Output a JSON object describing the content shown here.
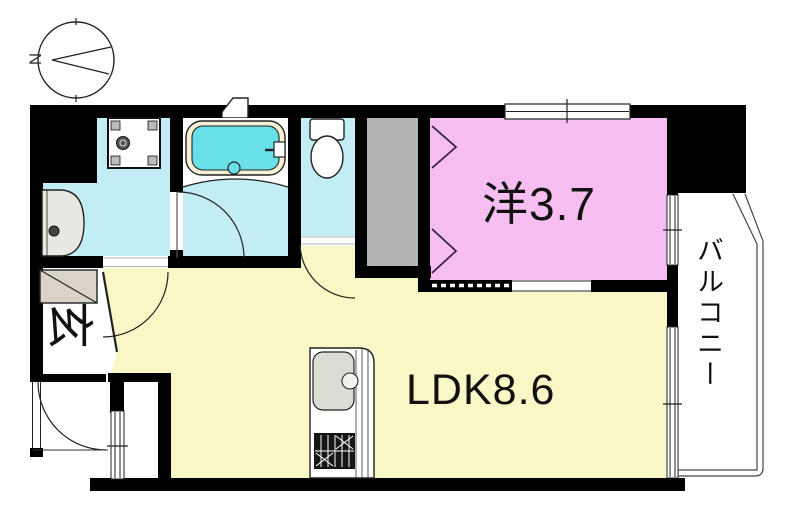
{
  "compass": {
    "north": "N"
  },
  "labels": {
    "western_room": "洋3.7",
    "ldk": "LDK8.6",
    "entrance": "玄",
    "balcony": "バルコニー"
  },
  "colors": {
    "wet_rooms": "#c3edf5",
    "bath_water": "#68dfe9",
    "tub_rim": "#f6f1d5",
    "western_room": "#f6bdf0",
    "ldk": "#faf7c6",
    "closet": "#b2b2b2",
    "shoe_cabinet": "#d9d3c9",
    "sink": "#dcdbd4",
    "washbasin": "#e8e7e1",
    "wall": "#000000"
  }
}
